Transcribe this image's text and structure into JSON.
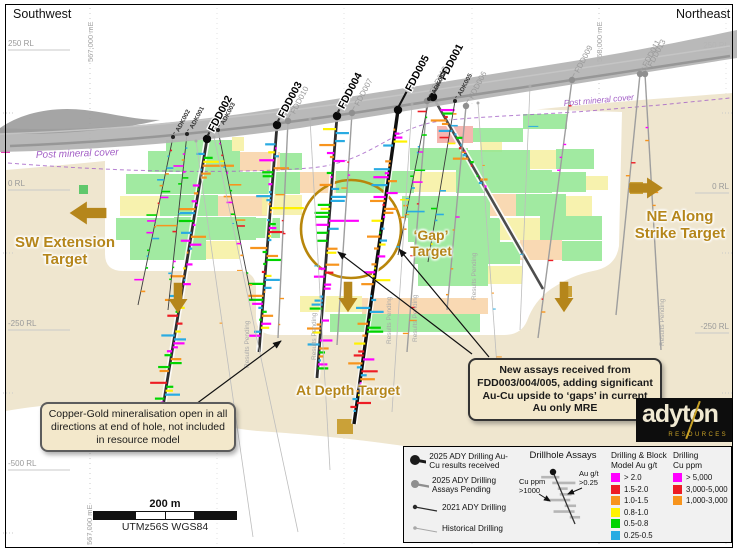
{
  "corners": {
    "top_left": "Southwest",
    "top_right": "Northeast"
  },
  "axis": {
    "rl_left": [
      {
        "label": "250 RL",
        "y": 46
      },
      {
        "label": "0 RL",
        "y": 186
      },
      {
        "label": "-250 RL",
        "y": 326
      },
      {
        "label": "-500 RL",
        "y": 466
      }
    ],
    "rl_right": [
      {
        "label": "250 RL",
        "y": 48,
        "faint": true
      },
      {
        "label": "0 RL",
        "y": 189
      },
      {
        "label": "-250 RL",
        "y": 329
      }
    ],
    "eastings_top": [
      {
        "label": "567,000 mE",
        "x": 93
      },
      {
        "label": "568,000 mE",
        "x": 602
      }
    ],
    "easting_bottom": {
      "label": "567,000 mE",
      "x": 92,
      "y": 545
    }
  },
  "post_mineral_cover": {
    "label": "Post mineral cover"
  },
  "targets": {
    "sw": {
      "text": "SW Extension\nTarget"
    },
    "ne": {
      "text": "NE Along\nStrike Target"
    },
    "gap": {
      "text": "‘Gap’\nTarget"
    },
    "depth": {
      "text": "At Depth Target"
    }
  },
  "annotations": {
    "left": {
      "text": "Copper-Gold mineralisation open in all directions at end of hole, not included in resource model"
    },
    "right": {
      "text": "New assays received from FDD003/004/005, adding significant Au-Cu upside to ‘gaps’ in current Au only MRE"
    }
  },
  "pending_note": "Results Pending",
  "pending_labels": [
    [
      249,
      368
    ],
    [
      316,
      360
    ],
    [
      391,
      344
    ],
    [
      417,
      342
    ],
    [
      476,
      300
    ],
    [
      664,
      346
    ]
  ],
  "gap_circle": {
    "cx": 351,
    "cy": 229,
    "rx": 50,
    "ry": 49
  },
  "pointer_arrows": [
    [
      196,
      404,
      281,
      341
    ],
    [
      472,
      354,
      338,
      252
    ],
    [
      489,
      357,
      399,
      249
    ]
  ],
  "gold_arrows": [
    {
      "x": 88,
      "y": 213,
      "dir": "left",
      "s": 1.15
    },
    {
      "x": 178,
      "y": 298,
      "dir": "down",
      "s": 0.95
    },
    {
      "x": 348,
      "y": 297,
      "dir": "down",
      "s": 0.95
    },
    {
      "x": 564,
      "y": 297,
      "dir": "down",
      "s": 0.95
    },
    {
      "x": 646,
      "y": 188,
      "dir": "right",
      "s": 1.05
    }
  ],
  "drillholes": [
    {
      "name": "FDD002",
      "type": "received",
      "x1": 207,
      "y1": 139,
      "x2": 158,
      "y2": 437
    },
    {
      "name": "FDD003",
      "type": "received",
      "x1": 277,
      "y1": 125,
      "x2": 259,
      "y2": 352
    },
    {
      "name": "FDD004",
      "type": "received",
      "x1": 337,
      "y1": 116,
      "x2": 317,
      "y2": 378
    },
    {
      "name": "FDD005",
      "type": "received",
      "x1": 398,
      "y1": 110,
      "x2": 354,
      "y2": 424,
      "lw": 3.4,
      "lc": "#101010",
      "off": 22
    },
    {
      "name": "FDD001",
      "type": "received",
      "x1": 433,
      "y1": 97,
      "x2": 543,
      "y2": 289,
      "lw": 2.6,
      "lc": "#4d4d4d",
      "off": 20,
      "barsEnd": 0.5
    },
    {
      "name": "FDD010",
      "type": "pending",
      "x1": 288,
      "y1": 121,
      "x2": 278,
      "y2": 338
    },
    {
      "name": "FDD007",
      "type": "pending",
      "x1": 352,
      "y1": 113,
      "x2": 337,
      "y2": 345
    },
    {
      "name": "FDD012",
      "type": "pending",
      "x1": 427,
      "y1": 101,
      "x2": 407,
      "y2": 352
    },
    {
      "name": "FDD006",
      "type": "pending",
      "x1": 466,
      "y1": 106,
      "x2": 447,
      "y2": 310
    },
    {
      "name": "FDD009",
      "type": "pending",
      "x1": 572,
      "y1": 80,
      "x2": 538,
      "y2": 338
    },
    {
      "name": "FDD011",
      "type": "pending",
      "x1": 640,
      "y1": 74,
      "x2": 616,
      "y2": 315
    },
    {
      "name": "FDD013",
      "type": "pending",
      "x1": 645,
      "y1": 74,
      "x2": 661,
      "y2": 350
    },
    {
      "name": "ADK002",
      "type": "ady2021",
      "x1": 173,
      "y1": 137,
      "x2": 138,
      "y2": 305
    },
    {
      "name": "ADK001",
      "type": "ady2021",
      "x1": 187,
      "y1": 134,
      "x2": 168,
      "y2": 310
    },
    {
      "name": "ADK003",
      "type": "ady2021",
      "x1": 218,
      "y1": 130,
      "x2": 252,
      "y2": 300
    },
    {
      "name": "ADK004",
      "type": "ady2021",
      "x1": 429,
      "y1": 99,
      "x2": 398,
      "y2": 255
    },
    {
      "name": "ADK005",
      "type": "ady2021",
      "x1": 455,
      "y1": 101,
      "x2": 428,
      "y2": 262
    },
    {
      "name": "",
      "type": "historical",
      "x1": 196,
      "y1": 141,
      "x2": 253,
      "y2": 537
    },
    {
      "name": "",
      "type": "historical",
      "x1": 214,
      "y1": 137,
      "x2": 298,
      "y2": 532
    },
    {
      "name": "",
      "type": "historical",
      "x1": 310,
      "y1": 119,
      "x2": 330,
      "y2": 470
    },
    {
      "name": "",
      "type": "historical",
      "x1": 412,
      "y1": 104,
      "x2": 392,
      "y2": 412
    },
    {
      "name": "",
      "type": "historical",
      "x1": 478,
      "y1": 103,
      "x2": 500,
      "y2": 408
    },
    {
      "name": "",
      "type": "historical",
      "x1": 530,
      "y1": 86,
      "x2": 520,
      "y2": 330
    }
  ],
  "block_colors": {
    "g": "#90e690",
    "y": "#f6f0a0",
    "p": "#f8d2a6",
    "s": "#f3a9a2",
    "o": "#c3941d",
    "G": "#46c25a"
  },
  "blocks": [
    [
      166,
      140,
      66,
      11,
      "g"
    ],
    [
      232,
      137,
      12,
      14,
      "y"
    ],
    [
      437,
      126,
      36,
      17,
      "s"
    ],
    [
      473,
      128,
      50,
      14,
      "g"
    ],
    [
      523,
      114,
      44,
      15,
      "g"
    ],
    [
      480,
      142,
      22,
      10,
      "y"
    ],
    [
      148,
      151,
      92,
      21,
      "g"
    ],
    [
      240,
      152,
      40,
      19,
      "p"
    ],
    [
      280,
      153,
      22,
      17,
      "g"
    ],
    [
      410,
      148,
      58,
      22,
      "g"
    ],
    [
      468,
      150,
      62,
      20,
      "g"
    ],
    [
      530,
      150,
      26,
      19,
      "y"
    ],
    [
      556,
      149,
      38,
      20,
      "g"
    ],
    [
      126,
      174,
      56,
      20,
      "g"
    ],
    [
      182,
      172,
      118,
      22,
      "g"
    ],
    [
      300,
      172,
      36,
      21,
      "p"
    ],
    [
      336,
      171,
      78,
      22,
      "g"
    ],
    [
      414,
      172,
      42,
      20,
      "y"
    ],
    [
      456,
      170,
      96,
      23,
      "g"
    ],
    [
      552,
      172,
      34,
      20,
      "g"
    ],
    [
      586,
      176,
      22,
      14,
      "y"
    ],
    [
      120,
      196,
      40,
      20,
      "y"
    ],
    [
      160,
      195,
      58,
      21,
      "g"
    ],
    [
      218,
      196,
      50,
      20,
      "p"
    ],
    [
      262,
      195,
      40,
      20,
      "y"
    ],
    [
      402,
      196,
      88,
      22,
      "g"
    ],
    [
      490,
      194,
      26,
      22,
      "p"
    ],
    [
      516,
      194,
      50,
      22,
      "g"
    ],
    [
      566,
      196,
      26,
      20,
      "y"
    ],
    [
      116,
      218,
      58,
      22,
      "g"
    ],
    [
      174,
      217,
      82,
      23,
      "g"
    ],
    [
      256,
      218,
      24,
      20,
      "g"
    ],
    [
      408,
      218,
      92,
      24,
      "g"
    ],
    [
      500,
      218,
      40,
      22,
      "y"
    ],
    [
      540,
      216,
      62,
      24,
      "g"
    ],
    [
      130,
      240,
      76,
      20,
      "g"
    ],
    [
      206,
      241,
      34,
      18,
      "y"
    ],
    [
      414,
      242,
      106,
      22,
      "g"
    ],
    [
      520,
      240,
      42,
      20,
      "p"
    ],
    [
      562,
      241,
      40,
      20,
      "g"
    ],
    [
      418,
      264,
      70,
      22,
      "g"
    ],
    [
      488,
      266,
      34,
      18,
      "y"
    ],
    [
      300,
      296,
      62,
      16,
      "y"
    ],
    [
      362,
      298,
      126,
      16,
      "p"
    ],
    [
      330,
      314,
      150,
      18,
      "g"
    ],
    [
      79,
      185,
      9,
      9,
      "G"
    ],
    [
      128,
      429,
      14,
      13,
      "o"
    ],
    [
      337,
      419,
      16,
      15,
      "o"
    ],
    [
      542,
      389,
      16,
      15,
      "o"
    ],
    [
      630,
      182,
      13,
      12,
      "o"
    ],
    [
      560,
      286,
      12,
      11,
      "o"
    ]
  ],
  "legend": {
    "drilling_types": [
      {
        "label": "2025 ADY Drilling Au-Cu results received",
        "r": 5,
        "line_w": 3,
        "color": "#1a1a1a"
      },
      {
        "label": "2025 ADY Drilling Assays Pending",
        "r": 4,
        "line_w": 2.4,
        "color": "#8f8f8f"
      },
      {
        "label": "2021 ADY Drilling",
        "r": 2.2,
        "line_w": 1.2,
        "color": "#2a2a2a"
      },
      {
        "label": "Historical Drilling",
        "r": 1.8,
        "line_w": 1,
        "color": "#a8a8a8"
      }
    ],
    "assays_title": "Drillhole Assays",
    "assay_left": "Cu ppm\n>1000",
    "assay_right": "Au g/t\n>0.25",
    "au_title": "Drilling & Block\nModel Au g/t",
    "au_scale": [
      {
        "label": "> 2.0",
        "color": "#ff00ff"
      },
      {
        "label": "1.5-2.0",
        "color": "#ed1c24"
      },
      {
        "label": "1.0-1.5",
        "color": "#f7941d"
      },
      {
        "label": "0.8-1.0",
        "color": "#fff200"
      },
      {
        "label": "0.5-0.8",
        "color": "#00d400"
      },
      {
        "label": "0.25-0.5",
        "color": "#29abe2"
      }
    ],
    "cu_title": "Drilling\nCu ppm",
    "cu_scale": [
      {
        "label": "> 5,000",
        "color": "#ff00ff"
      },
      {
        "label": "3,000-5,000",
        "color": "#ed1c24"
      },
      {
        "label": "1,000-3,000",
        "color": "#f7941d"
      }
    ]
  },
  "scalebar": {
    "label": "200 m",
    "crs": "UTMz56S WGS84"
  },
  "logo": {
    "name": "adyton",
    "sub": "RESOURCES"
  },
  "palette": {
    "gold": "#b5861b",
    "tan": "#efe6cf",
    "terrain": "#b3b3b3",
    "purple": "#a35fc6"
  }
}
